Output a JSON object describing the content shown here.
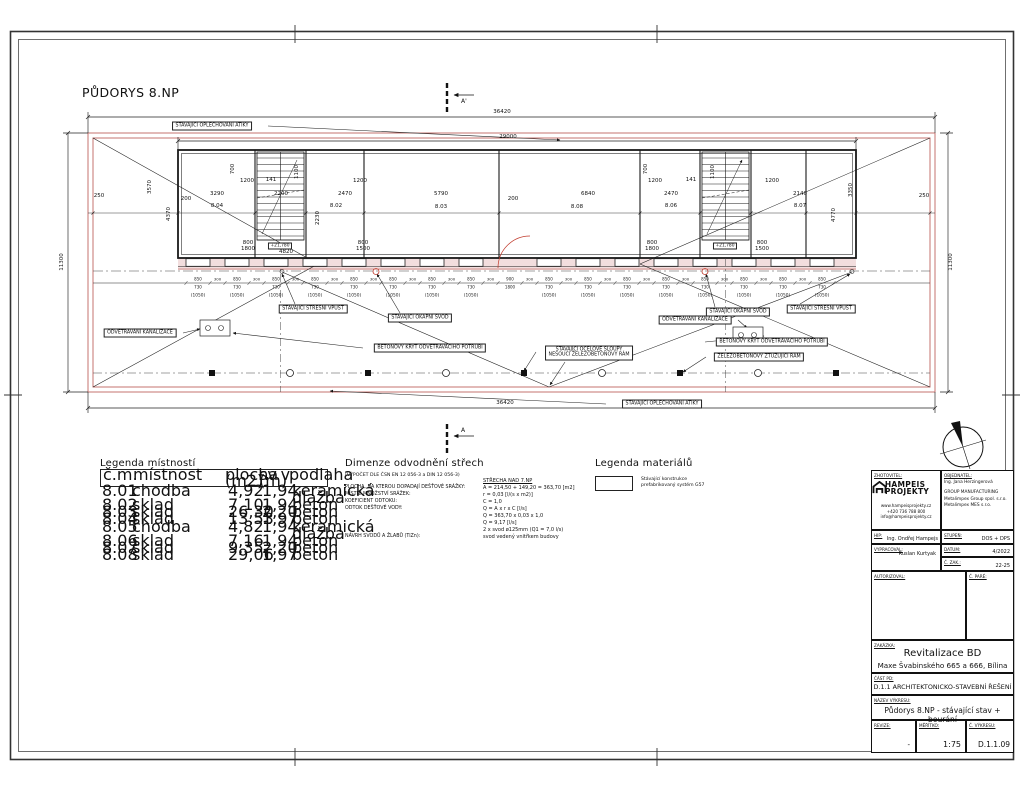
{
  "sheet": {
    "title": "PŮDORYS 8.NP"
  },
  "plan": {
    "labels": {
      "atika": "STÁVAJÍCÍ OPLECHOVÁNÍ ATIKY",
      "stresni_vpust": "STÁVAJÍCÍ STŘEŠNÍ VPUSŤ",
      "okapni_svod": "STÁVAJÍCÍ OKAPNÍ SVOD",
      "odvetravani": "ODVĚTRÁVÁNÍ KANALIZACE",
      "betonovy_kryt": "BETONOVÝ KRYT ODVĚTRÁVACÍHO POTRUBÍ",
      "sloupy1": "STÁVAJÍCÍ OCELOVÉ SLOUPY",
      "sloupy2": "NESOUCÍ ŽELEZOBETONOVÝ RÁM",
      "ztuzujici_ram": "ŽELEZOBETONOVÝ ZTUŽUJÍCÍ RÁM"
    },
    "section": {
      "top": "A'",
      "bottom": "A"
    },
    "level_mark": "+21,780",
    "chain": {
      "top": "850",
      "bottom": "730",
      "paren": "(1050)",
      "gap": "300",
      "door_top": "900",
      "door_bottom": "1800"
    },
    "dim_texts": [
      "36420",
      "29000",
      "36420",
      "11300",
      "11300",
      "250",
      "3290",
      "2200",
      "2470",
      "5790",
      "6840",
      "2470",
      "2140",
      "250",
      "8.04",
      "8.02",
      "8.03",
      "8.08",
      "8.06",
      "8.07",
      "3570",
      "4370",
      "3350",
      "4770",
      "1200",
      "141",
      "1200",
      "1200",
      "141",
      "1200",
      "700",
      "1100",
      "700",
      "1100",
      "2230",
      "4820",
      "200",
      "200",
      "800",
      "1800",
      "800",
      "1500",
      "800",
      "1800",
      "800",
      "1500"
    ]
  },
  "legend_rooms": {
    "title": "Legenda místností",
    "headers": [
      [
        "č.m.",
        ""
      ],
      [
        "místnost",
        ""
      ],
      [
        "plocha",
        "(m2)"
      ],
      [
        "sv.v.",
        "(m)"
      ],
      [
        "podlaha",
        ""
      ]
    ],
    "rows": [
      [
        "8.01",
        "chodba",
        "4,92",
        "1,94",
        "keramická dlažba"
      ],
      [
        "8.02",
        "sklad",
        "7,10",
        "1,94",
        "beton"
      ],
      [
        "8.03",
        "sklad",
        "26,30",
        "2,20",
        "beton"
      ],
      [
        "8.04",
        "sklad",
        "13,53",
        "1,97",
        "beton"
      ],
      [
        "8.05",
        "chodba",
        "4,82",
        "1,94",
        "keramická dlažba"
      ],
      [
        "8.06",
        "sklad",
        "7,16",
        "1,94",
        "beton"
      ],
      [
        "8.07",
        "sklad",
        "9,35",
        "2,20",
        "beton"
      ],
      [
        "8.08",
        "sklad",
        "29,06",
        "1,97",
        "beton"
      ]
    ]
  },
  "drainage": {
    "title": "Dimenze odvodnění střech",
    "subtitle": "(VÝPOČET DLE ČSN EN 12 056-3 a DIN 12 056-3)",
    "left_lines": [
      "PLOCHA, NA KTEROU DOPADAJÍ DEŠŤOVÉ SRÁŽKY:",
      "MÍSTNÍ MNOŽSTVÍ SRÁŽEK:",
      "KOEFICIENT ODTOKU:",
      "ODTOK DEŠŤOVÉ VODY:",
      "",
      "NÁVRH SVODŮ A ŽLABŮ (TiZn):"
    ],
    "right_header": "STŘECHA NAD 7.NP",
    "right_lines": [
      "A = 214,50 + 149,20 = 363,70 [m2]",
      "r = 0,03 [l/(s x m2)]",
      "C = 1,0",
      "Q = A x r x C [l/s]",
      "Q = 363,70 x 0,03 x 1,0",
      "Q = 9,17 [l/s]",
      "2 x svod ø125mm (Q1 = 7,0 l/s)",
      "svod vedený vnitřkem budovy"
    ]
  },
  "legend_materials": {
    "title": "Legenda materiálů",
    "item_line1": "Stávající konstrukce",
    "item_line2": "prefabrikovaný systém G57"
  },
  "titleblock": {
    "zhotovitel_label": "ZHOTOVITEL:",
    "logo_line1": "HAMPEIS",
    "logo_line2": "PROJEKTY",
    "contact": [
      "www.hampeisprojekty.cz",
      "+420 736 788 800",
      "info@hampeisprojekty.cz"
    ],
    "objednatel_label": "OBJEDNATEL:",
    "objednatel_lines": [
      "Ing. Jana Herzingerová",
      "GROUP MANUFACTURING",
      "Metalimpex Group spol. s.r.o.",
      "Metalimpex MES s.r.o."
    ],
    "hip_label": "HIP:",
    "hip_value": "Ing. Ondřej Hampejs",
    "stupen_label": "STUPEŇ:",
    "stupen_value": "DOS + DPS",
    "vypracoval_label": "VYPRACOVAL:",
    "vypracoval_value": "Ruslan Kurtyak",
    "datum_label": "DATUM:",
    "datum_value": "4/2022",
    "c_zak_label": "Č. ZAK.:",
    "c_zak_value": "22-25",
    "autorizoval_label": "AUTORIZOVAL:",
    "c_pare_label": "Č. PARÉ:",
    "zakazka_label": "ZAKÁZKA:",
    "zakazka_name": "Revitalizace BD",
    "zakazka_address": "Maxe Švabinského 665 a 666, Bílina",
    "cast_pd_label": "ČÁST PD:",
    "cast_pd_value": "D.1.1 ARCHITEKTONICKO-STAVEBNÍ ŘEŠENÍ",
    "nazev_label": "NÁZEV VÝKRESU:",
    "nazev_value": "Půdorys 8.NP - stávající stav + bourání",
    "revize_label": "REVIZE:",
    "revize_value": "-",
    "meritko_label": "MĚŘÍTKO:",
    "meritko_value": "1:75",
    "c_vykresu_label": "Č. VÝKRESU:",
    "c_vykresu_value": "D.1.1.09"
  },
  "colors": {
    "line": "#1a1a1a",
    "existing_red": "#c4736f",
    "accent_red": "#c0392b",
    "band_pink": "#f2dede"
  }
}
